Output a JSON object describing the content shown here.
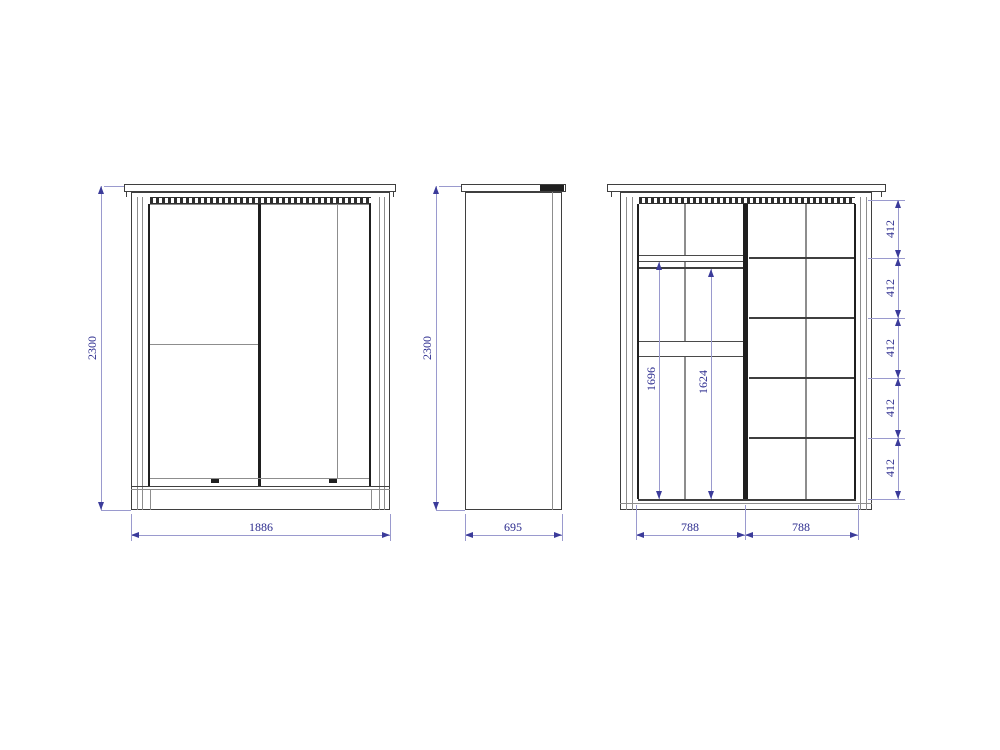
{
  "drawing": {
    "palette": {
      "background": "#ffffff",
      "outline": "#3f3f3f",
      "dark_edge": "#1f1f1f",
      "dimension_line": "#9a9ace",
      "dimension_text": "#2b2b8e"
    },
    "views": {
      "front": {
        "height": "2300",
        "width": "1886"
      },
      "side": {
        "height": "2300",
        "depth": "695"
      },
      "internal": {
        "hang_left": "1696",
        "hang_right": "1624",
        "shelf_spacings": [
          "412",
          "412",
          "412",
          "412",
          "412"
        ],
        "bottom_widths": [
          "788",
          "788"
        ]
      }
    }
  }
}
